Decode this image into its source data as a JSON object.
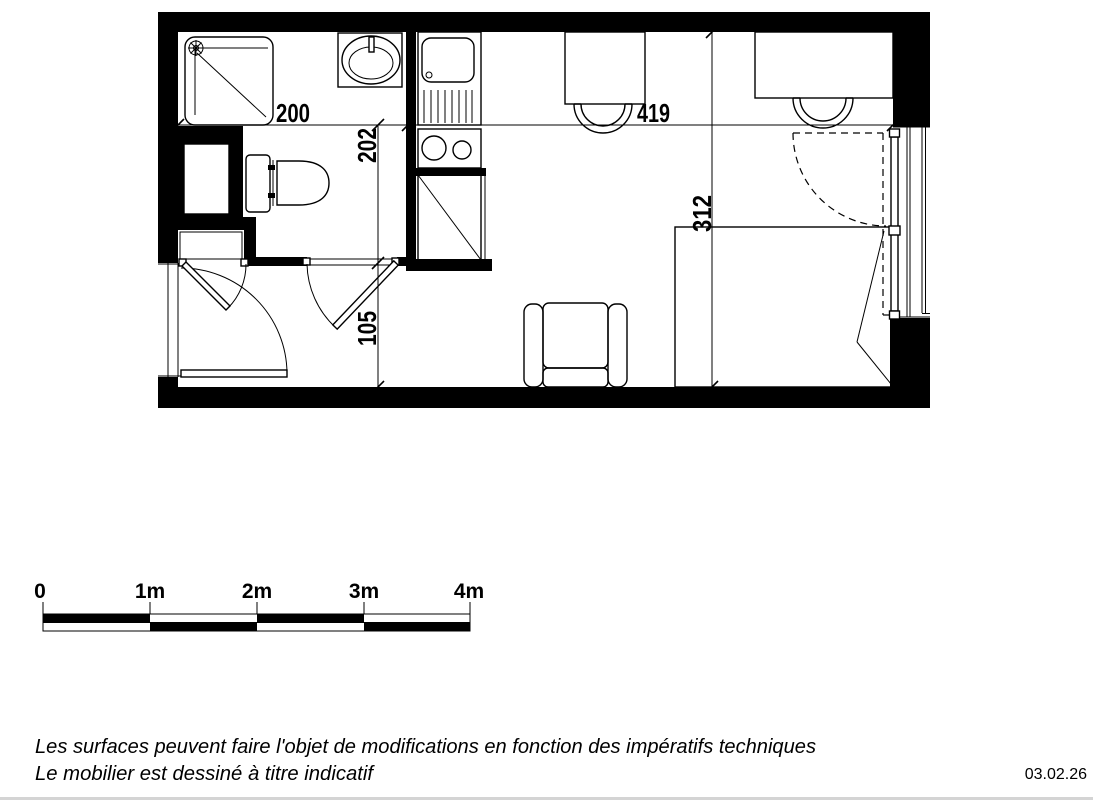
{
  "floor_plan": {
    "dimensions": {
      "bathroom_width_cm": "200",
      "bathroom_depth_cm": "202",
      "main_room_width_cm": "419",
      "main_room_depth_cm": "312",
      "entry_depth_cm": "105"
    }
  },
  "scale_bar": {
    "labels": [
      "0",
      "1m",
      "2m",
      "3m",
      "4m"
    ]
  },
  "footer": {
    "line1": "Les surfaces peuvent faire l'objet de modifications en fonction des impératifs techniques",
    "line2": "Le mobilier est dessiné à titre indicatif",
    "date": "03.02.26"
  },
  "colors": {
    "ink": "#000000",
    "background": "#ffffff"
  }
}
